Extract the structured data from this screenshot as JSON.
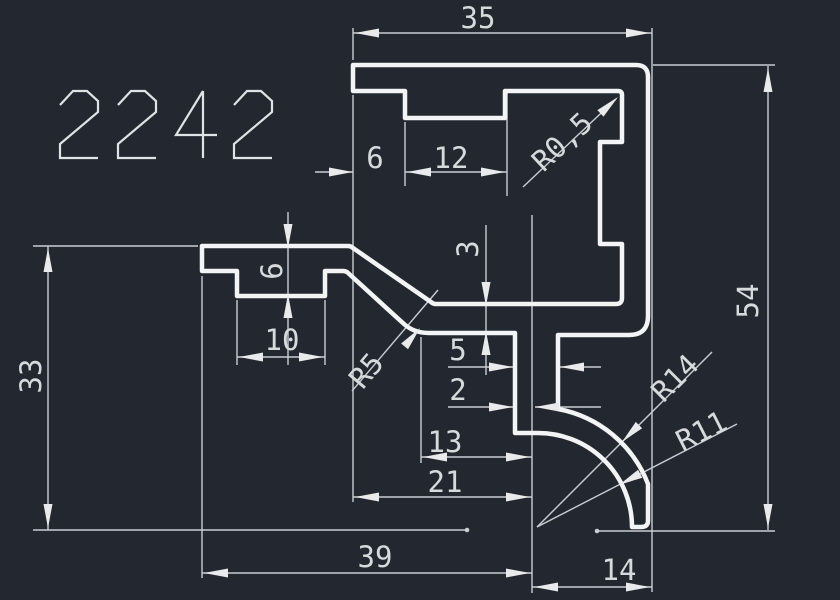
{
  "drawing": {
    "background_color": "#232830",
    "profile_line_color": "#f2f4f5",
    "dim_line_color": "#c9ced2",
    "arrow_color": "#e8eaec",
    "text_color": "#d7dadd",
    "title_color": "#dfe3e5",
    "title": "2242",
    "dims": {
      "d35": "35",
      "d6_top": "6",
      "d12": "12",
      "r05": "R0,5",
      "d6_left": "6",
      "d10": "10",
      "d33": "33",
      "d3": "3",
      "d5": "5",
      "d2": "2",
      "d13": "13",
      "d21": "21",
      "d39": "39",
      "d14": "14",
      "d54": "54",
      "r5": "R5",
      "r14": "R14",
      "r11": "R11"
    }
  }
}
